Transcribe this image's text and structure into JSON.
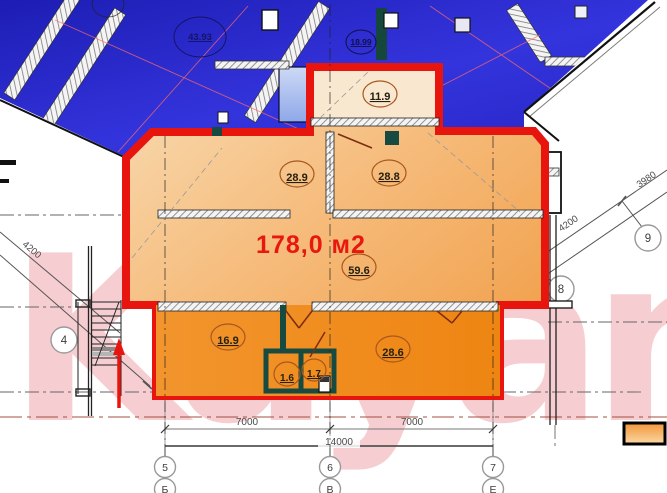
{
  "watermark": "Kayan",
  "main_area": "178,0 м2",
  "room_labels": {
    "r43_93": "43.93",
    "r18_99": "18.99",
    "r11_9": "11.9",
    "r28_9": "28.9",
    "r28_8": "28.8",
    "r59_6": "59.6",
    "r16_9": "16.9",
    "r1_6": "1.6",
    "r1_7": "1.7",
    "r28_6": "28.6"
  },
  "dimensions": {
    "bottom_left_span": "7000",
    "bottom_right_span": "7000",
    "bottom_total": "14000",
    "left_diagonal": "4200",
    "right_diagonal": "4200",
    "right_diagonal_upper": "3980"
  },
  "grid_marks": {
    "col_5": "5",
    "col_6": "6",
    "col_7": "7",
    "row_b": "Б",
    "row_v": "В",
    "row_e": "Е",
    "axis_4": "4",
    "axis_8": "8",
    "axis_9": "9"
  },
  "colors": {
    "highlight_red": "#e8150e",
    "apartment_orange": "#f09a40",
    "neighbor_blue": "#2a2ad0",
    "watermark_pink": "#f5c6c9"
  }
}
